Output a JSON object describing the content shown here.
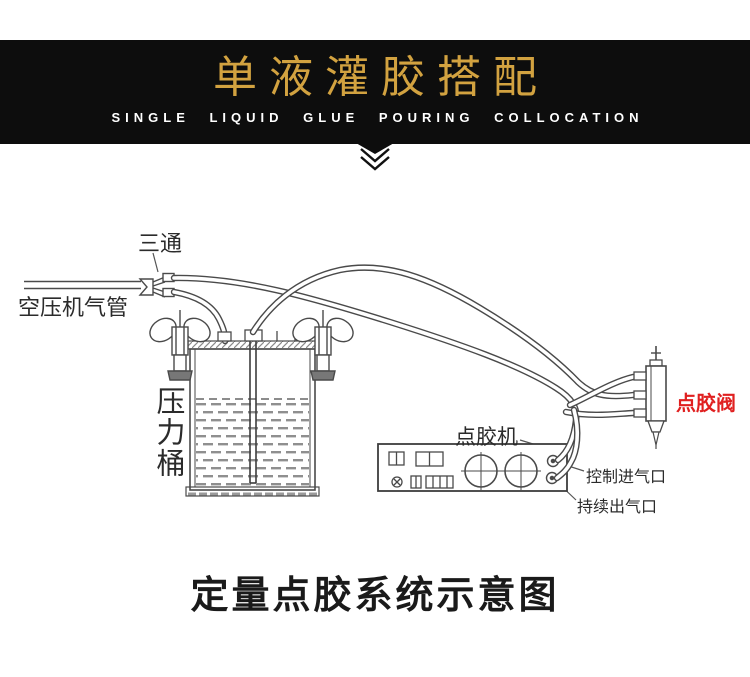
{
  "header": {
    "title_cn": "单液灌胶搭配",
    "title_en": "SINGLE LIQUID GLUE POURING COLLOCATION",
    "band_color": "#0d0d0d",
    "title_color": "#d2a240",
    "subtitle_color": "#ffffff"
  },
  "diagram": {
    "labels": {
      "tee": "三通",
      "air_pipe": "空压机气管",
      "pressure_barrel": "压力桶",
      "dispenser": "点胶机",
      "valve": "点胶阀",
      "control_inlet": "控制进气口",
      "continuous_outlet": "持续出气口"
    },
    "valve_label_color": "#e02020",
    "line_color": "#4a4a4a"
  },
  "caption": "定量点胶系统示意图"
}
